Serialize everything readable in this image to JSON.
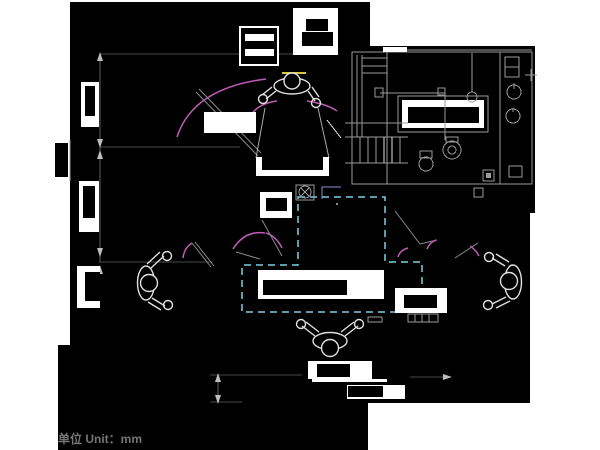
{
  "page": {
    "width": 600,
    "height": 450,
    "background": "#ffffff"
  },
  "drawing": {
    "type": "cad-floor-plan",
    "unit_note": "单位  Unit：mm",
    "colors": {
      "plan_fill": "#000000",
      "wall_line": "#ffffff",
      "fixture_line": "#9a9a9a",
      "dimension_line": "#5f5f5f",
      "door_swing_magenta": "#c05cb8",
      "activity_zone_cyan": "#7fd0e4",
      "callout_lavender": "#8890cc",
      "highlight_yellow": "#d8c840",
      "note_text_gray": "#757575"
    },
    "elements": {
      "rooms": [
        "top-left-room",
        "left-middle-room",
        "left-lower-room",
        "central-hall",
        "bathroom",
        "right-room",
        "lower-hall"
      ],
      "fixtures": [
        "wardrobe",
        "stove-unit",
        "bathtub",
        "toilet",
        "bidet",
        "shower-column",
        "washbasin-1",
        "washbasin-2",
        "floor-drain",
        "staircase",
        "desk-large",
        "desk-small-1",
        "desk-small-2",
        "side-table",
        "bench-u",
        "radiator-unit",
        "window-1",
        "window-2",
        "window-3"
      ],
      "figures": [
        "person-at-dresser-top",
        "person-seated-left",
        "person-seated-right",
        "person-seated-bottom"
      ],
      "annotations": [
        "door-swing-arcs",
        "activity-zone-dashed-boundary",
        "dimension-arrows",
        "unit-note"
      ]
    }
  }
}
